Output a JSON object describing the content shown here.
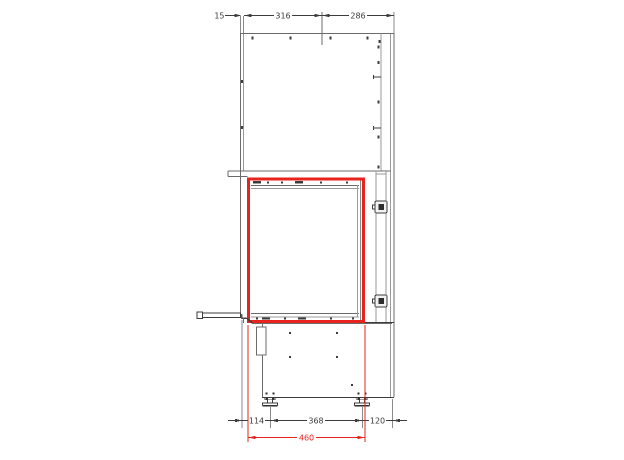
{
  "page": {
    "background": "#ffffff"
  },
  "drawing": {
    "title": "fireplace-insert-elevation",
    "colors": {
      "structure_line": "#6b6b6b",
      "light_line": "#9a9a9a",
      "detail_line": "#3c3c3c",
      "highlight": "#e8231e",
      "text": "#3c3c3c"
    },
    "dimensions": {
      "top": [
        {
          "label": "15"
        },
        {
          "label": "316"
        },
        {
          "label": "286"
        }
      ],
      "bottom": [
        {
          "label": "114"
        },
        {
          "label": "368"
        },
        {
          "label": "120"
        }
      ],
      "highlight": {
        "label": "460"
      }
    }
  }
}
